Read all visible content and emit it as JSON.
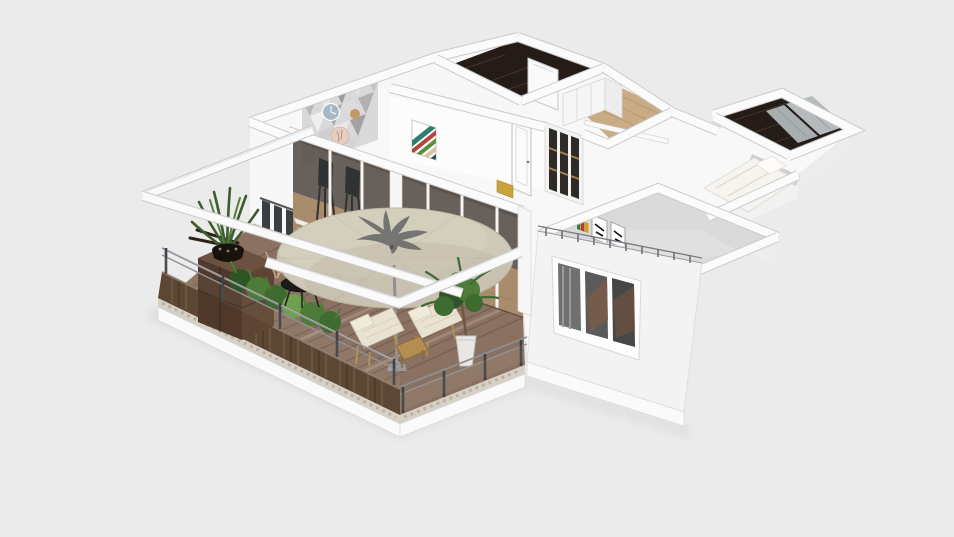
{
  "scene": {
    "app_context": "3d-home-floorplan-render",
    "background": "#EBEBEB",
    "colors": {
      "wall_white": "#F8F8F8",
      "wall_face": "#F3F3F3",
      "wall_shade": "#ECECEC",
      "marble_dark": "#251C17",
      "marble_vein": "#6B5747",
      "wood_floor": "#C9AC85",
      "interior_wood": "#A8855F",
      "interior_shadow": "#4A4038",
      "deck_wood": "#8B7161",
      "plank_wall": "#5C4634",
      "stone_ledge": "#D7D1C5",
      "umbrella": "#D0C9B9",
      "umbrella_ornament": "#6F6F6F",
      "greenery": "#4F7B38",
      "greenery_dark": "#2F5526",
      "greenery_light": "#6FA050",
      "lounger": "#E9E2D1",
      "lounger_frame": "#B38E50",
      "coffee_table": "#1B1B1B",
      "gray_floor": "#DADADA",
      "wardrobe_gray": "#B5BABC",
      "bed_white": "#F6F4EF",
      "clock_blue": "#A4B8C6",
      "art_circle": "#E5CEC1",
      "art_knob": "#C29B64",
      "art_teal": "#2E7D6E",
      "art_red": "#B5443A",
      "art_green": "#5A8F3C",
      "art_cream": "#D8C49A",
      "gold_mosaic": "#C8A23C",
      "railing_metal": "#8D9094",
      "railing_post": "#3F4246",
      "glass_dark": "#474747",
      "sideboard_wood": "#50392A",
      "pot_black": "#17120E",
      "window_frame": "#FDFDFD"
    },
    "objects": [
      "terrace-deck",
      "patio-umbrella",
      "pergola-beams",
      "glass-railing",
      "wood-privacy-wall",
      "planter-shrubs",
      "sideboard",
      "potted-agave",
      "coffee-table",
      "sun-loungers",
      "potted-tree",
      "living-room-glass-doors",
      "dining-chairs",
      "triangle-accent-wall",
      "wall-clock",
      "chevron-artwork",
      "hall-door",
      "shelving-unit",
      "marble-bathroom",
      "wood-corridor",
      "wardrobe-cabinets",
      "master-bed",
      "gray-bedroom",
      "bedroom-artwork",
      "bedroom-door",
      "exterior-window",
      "balcony-railing"
    ]
  }
}
